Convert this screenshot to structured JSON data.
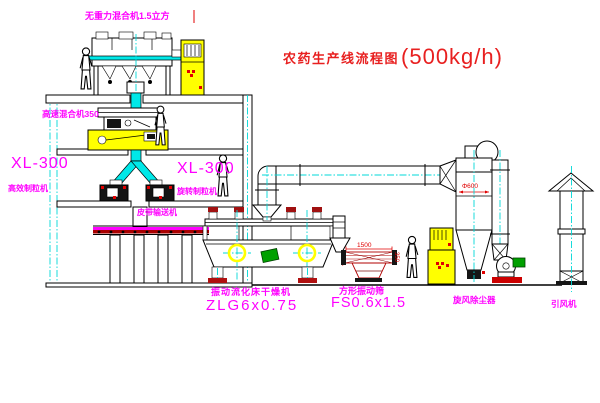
{
  "title": {
    "text": "农药生产线流程图",
    "capacity": "(500kg/h)"
  },
  "labels": {
    "gravity_mixer": "无重力混合机1.5立方",
    "high_speed_mixer": "高速混合机350",
    "granulator_left_model": "XL-300",
    "granulator_left_name": "高效制粒机",
    "granulator_right_model": "XL-300",
    "granulator_right_name": "旋转制粒机",
    "belt_conveyor": "皮带输送机",
    "dryer_name": "振动流化床干燥机",
    "dryer_model": "ZLG6x0.75",
    "screen_name": "方形振动筛",
    "screen_model": "FS0.6x1.5",
    "cyclone": "旋风除尘器",
    "fan": "引风机"
  },
  "dimensions": {
    "cyclone_diameter": "Φ600",
    "screen_length": "1500",
    "screen_height": "350"
  },
  "colors": {
    "label_magenta": "#ff00ff",
    "title_red": "#e82020",
    "pipe_cyan": "#00e8e8",
    "cabinet_yellow": "#ffff00",
    "motor_green": "#00a000",
    "accent_red": "#cc0000",
    "line_black": "#000000",
    "background": "#ffffff"
  }
}
